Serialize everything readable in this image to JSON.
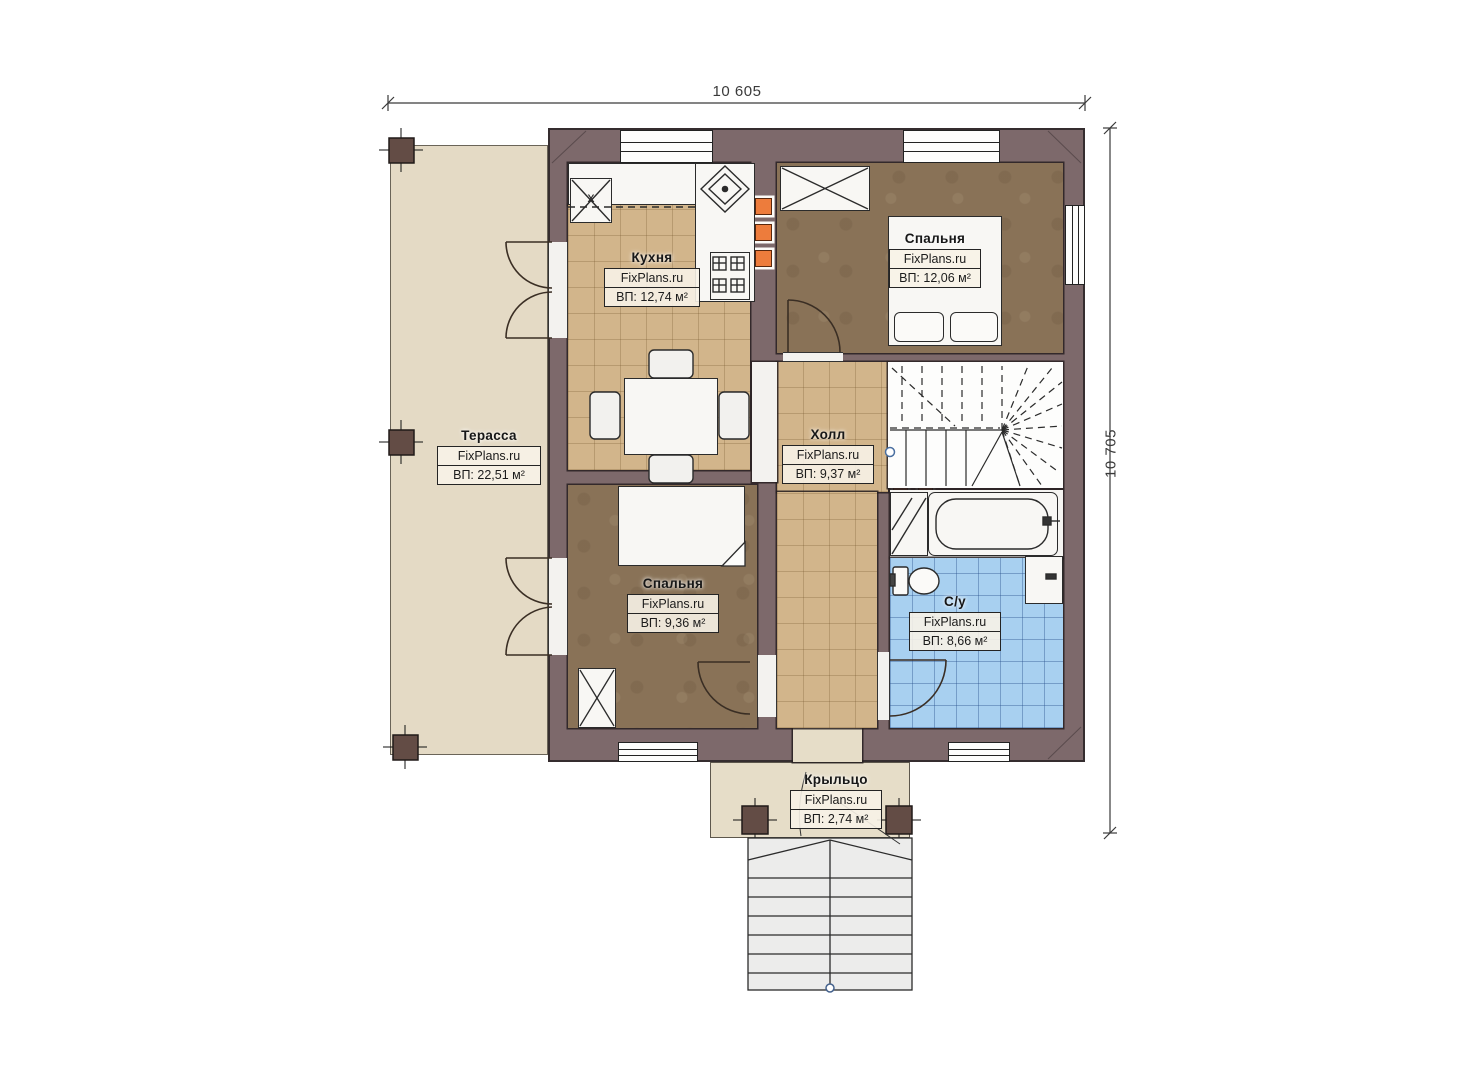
{
  "watermark": "FixPlans.ru",
  "dimensions": {
    "width": "10 605",
    "height": "10 705"
  },
  "rooms": {
    "terrace": {
      "name": "Терасса",
      "area": "ВП: 22,51 м²"
    },
    "kitchen": {
      "name": "Кухня",
      "area": "ВП: 12,74 м²"
    },
    "bedroom_top": {
      "name": "Спальня",
      "area": "ВП: 12,06 м²"
    },
    "hall": {
      "name": "Холл",
      "area": "ВП: 9,37 м²"
    },
    "bedroom_bottom": {
      "name": "Спальня",
      "area": "ВП: 9,36 м²"
    },
    "bathroom": {
      "name": "С/у",
      "area": "ВП: 8,66 м²"
    },
    "porch": {
      "name": "Крыльцо",
      "area": "ВП: 2,74 м²"
    }
  },
  "markers": {
    "appliance": "x"
  },
  "colors": {
    "wall": "#7d696b",
    "terrace_floor": "#e4dac5",
    "tile_floor": "#d2b58b",
    "bedroom_floor": "#897257",
    "bathroom_floor": "#a8d0f0",
    "vent_accent": "#ed7c3c",
    "porch_floor": "#e6ddc8"
  }
}
